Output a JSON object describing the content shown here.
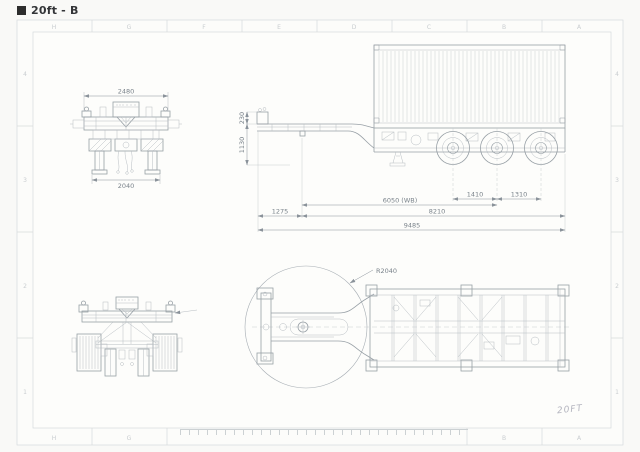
{
  "title": "20ft - B",
  "frame": {
    "columns": [
      "H",
      "G",
      "F",
      "E",
      "D",
      "C",
      "B",
      "A"
    ],
    "rows": [
      "4",
      "3",
      "2",
      "1"
    ]
  },
  "front_view": {
    "width_top": "2480",
    "width_bottom": "2040"
  },
  "side_view": {
    "neck_step": "230",
    "deck_height": "1130",
    "front_overhang": "1275",
    "wheelbase": "6050 (WB)",
    "kingpin_to_rear": "8210",
    "overall_length": "9485",
    "axle_spacing_front": "1410",
    "axle_spacing_rear": "1310"
  },
  "plan_view": {
    "swing_radius": "R2040"
  },
  "notes": {
    "handwritten": "20FT"
  },
  "colors": {
    "line": "#98a0a6",
    "line_light": "#b7bdc2",
    "dim": "#8a929a",
    "dim_text": "#79828a",
    "frame_line": "#d6dadc",
    "grid_text": "#c9cdd0",
    "title_text": "#333538",
    "note_text": "#b3b4be",
    "background": "#f9f9f7"
  }
}
